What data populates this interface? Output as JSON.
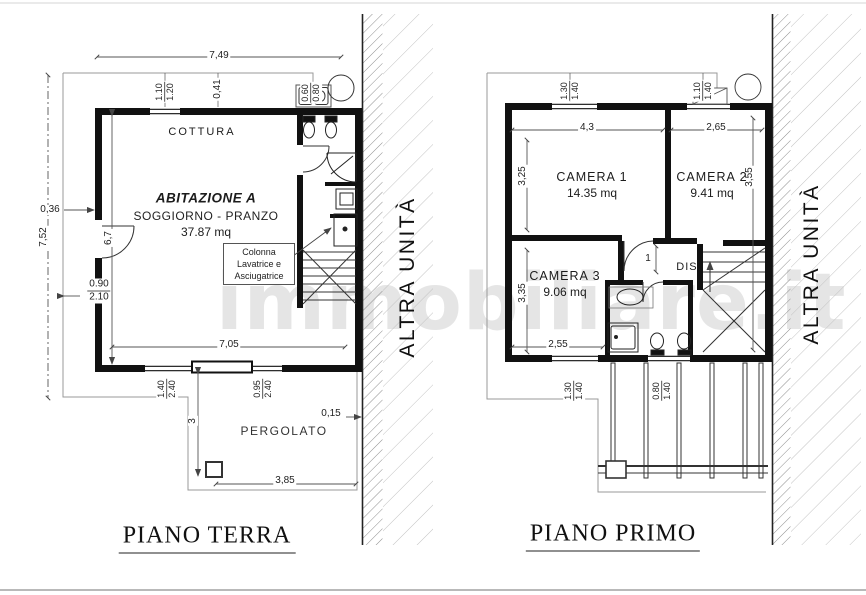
{
  "watermark": "immobiliare.it",
  "ground_floor": {
    "title": "PIANO TERRA",
    "adjacent_label": "ALTRA UNITÀ",
    "kitchen_label": "COTTURA",
    "unit_name": "ABITAZIONE A",
    "room_label": "SOGGIORNO - PRANZO",
    "room_area": "37.87 mq",
    "pergola_label": "PERGOLATO",
    "laundry_note": {
      "line1": "Colonna",
      "line2": "Lavatrice e",
      "line3": "Asciugatrice"
    },
    "dims": {
      "top_width": "7,49",
      "win_top": {
        "a": "1.10",
        "b": "1.20"
      },
      "wall_offset_top": "0,41",
      "bath_win": {
        "a": "0.60",
        "b": "0.80"
      },
      "left_offset": "0,36",
      "total_height": "7,52",
      "inner_height": "6,7",
      "door_left": {
        "a": "0.90",
        "b": "2.10"
      },
      "bottom_width": "7,05",
      "win_bottom_left": {
        "a": "1.40",
        "b": "2.40"
      },
      "win_bottom_right": {
        "a": "0.95",
        "b": "2.40"
      },
      "pergola_depth": "3",
      "wall_gap": "0,15",
      "pergola_width": "3,85"
    }
  },
  "first_floor": {
    "title": "PIANO PRIMO",
    "adjacent_label": "ALTRA UNITÀ",
    "camera1_name": "CAMERA 1",
    "camera1_area": "14.35 mq",
    "camera2_name": "CAMERA 2",
    "camera2_area": "9.41 mq",
    "camera3_name": "CAMERA 3",
    "camera3_area": "9.06 mq",
    "hall_label": "DIS.",
    "dims": {
      "win1_top": {
        "a": "1.30",
        "b": "1.40"
      },
      "win2_top": {
        "a": "1.10",
        "b": "1.40"
      },
      "camera1_width": "4,3",
      "camera2_width": "2,65",
      "camera1_depth": "3,25",
      "camera2_depth": "3,55",
      "camera3_depth": "3,35",
      "camera3_width": "2,55",
      "door_width": "1",
      "win1_bottom": {
        "a": "1.30",
        "b": "1.40"
      },
      "win2_bottom": {
        "a": "0.80",
        "b": "1.40"
      }
    }
  }
}
